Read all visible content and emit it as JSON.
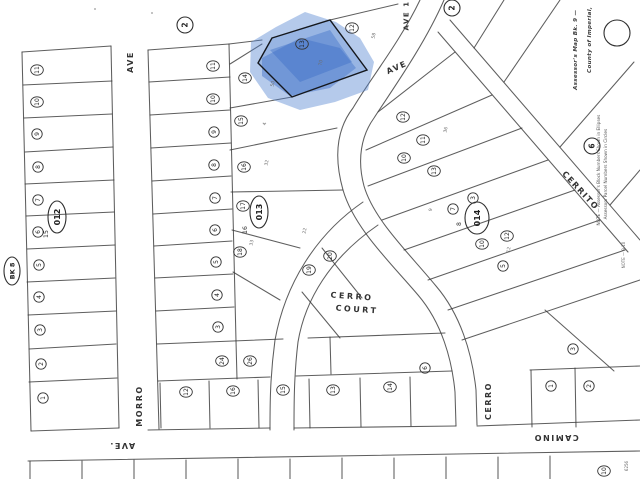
{
  "map": {
    "background": "#ffffff",
    "line_color": "#3a3a3a",
    "highlight": {
      "fill": "#4f81d0",
      "streak_fill": "#2f62c0",
      "wash_opacity": 0.42,
      "streak_opacity": 0.4,
      "lot_fill_opacity": 0.28,
      "wash": [
        [
          251,
          42
        ],
        [
          276,
          27
        ],
        [
          305,
          12
        ],
        [
          336,
          22
        ],
        [
          360,
          38
        ],
        [
          374,
          62
        ],
        [
          368,
          90
        ],
        [
          335,
          102
        ],
        [
          300,
          110
        ],
        [
          268,
          98
        ],
        [
          250,
          72
        ]
      ],
      "streaks": [
        [
          [
            262,
            58
          ],
          [
            300,
            38
          ],
          [
            340,
            48
          ],
          [
            356,
            68
          ],
          [
            330,
            88
          ],
          [
            290,
            96
          ],
          [
            262,
            76
          ]
        ],
        [
          [
            270,
            50
          ],
          [
            330,
            30
          ],
          [
            352,
            62
          ],
          [
            300,
            82
          ]
        ]
      ],
      "lot": [
        [
          272,
          38
        ],
        [
          330,
          20
        ],
        [
          367,
          70
        ],
        [
          292,
          97
        ],
        [
          258,
          63
        ]
      ]
    },
    "streets": {
      "ave_west": "AVE",
      "morro": "MORRO",
      "ave_south": "AVE.",
      "camino": "CAMINO",
      "cerro_court_1": "CERRO",
      "cerro_court_2": "COURT",
      "cerro": "CERRO",
      "cerrito": "CERRITO",
      "ave_diag": "AVE",
      "ave_one": "AVE 1"
    },
    "margin": {
      "line1": "Assessor's Map Bk. 9 —",
      "line2": "County of Imperial,",
      "note1": "NOTE — Assessor's Block Numbers Shown in Ellipses",
      "note2": "Assessors Parcel Numbers Shown in Circles",
      "side_note": "NOTE — 9-10",
      "corner_num": "6256"
    },
    "blocks": [
      {
        "label": "BK 8",
        "x": 12,
        "y": 271,
        "rx": 8,
        "ry": 14,
        "font": 6.5,
        "companion": "",
        "cx": 0,
        "cy": 0
      },
      {
        "label": "012",
        "x": 57,
        "y": 217,
        "rx": 9,
        "ry": 16,
        "font": 8,
        "companion": "15",
        "cx": 48,
        "cy": 234
      },
      {
        "label": "013",
        "x": 259,
        "y": 212,
        "rx": 9,
        "ry": 16,
        "font": 8,
        "companion": "16",
        "cx": 247,
        "cy": 230
      },
      {
        "label": "014",
        "x": 477,
        "y": 218,
        "rx": 12,
        "ry": 16,
        "font": 8,
        "companion": "8",
        "cx": 461,
        "cy": 224
      }
    ],
    "ref_circles": [
      {
        "label": "2",
        "x": 185,
        "y": 25,
        "r": 8
      },
      {
        "label": "2",
        "x": 452,
        "y": 8,
        "r": 8
      },
      {
        "label": "6",
        "x": 592,
        "y": 146,
        "r": 8
      },
      {
        "label": "",
        "x": 617,
        "y": 33,
        "r": 13
      }
    ],
    "parcels": [
      {
        "n": "11",
        "x": 37,
        "y": 70
      },
      {
        "n": "10",
        "x": 37,
        "y": 102
      },
      {
        "n": "9",
        "x": 37,
        "y": 134
      },
      {
        "n": "8",
        "x": 38,
        "y": 167
      },
      {
        "n": "7",
        "x": 38,
        "y": 200
      },
      {
        "n": "6",
        "x": 38,
        "y": 232
      },
      {
        "n": "5",
        "x": 39,
        "y": 265
      },
      {
        "n": "4",
        "x": 39,
        "y": 297
      },
      {
        "n": "3",
        "x": 40,
        "y": 330
      },
      {
        "n": "2",
        "x": 41,
        "y": 364
      },
      {
        "n": "1",
        "x": 43,
        "y": 398
      },
      {
        "n": "11",
        "x": 213,
        "y": 66
      },
      {
        "n": "10",
        "x": 213,
        "y": 99
      },
      {
        "n": "9",
        "x": 214,
        "y": 132
      },
      {
        "n": "8",
        "x": 214,
        "y": 165
      },
      {
        "n": "7",
        "x": 215,
        "y": 198
      },
      {
        "n": "6",
        "x": 215,
        "y": 230
      },
      {
        "n": "5",
        "x": 216,
        "y": 262
      },
      {
        "n": "4",
        "x": 217,
        "y": 295
      },
      {
        "n": "3",
        "x": 218,
        "y": 327
      },
      {
        "n": "14",
        "x": 245,
        "y": 78
      },
      {
        "n": "15",
        "x": 241,
        "y": 121
      },
      {
        "n": "16",
        "x": 244,
        "y": 167
      },
      {
        "n": "17",
        "x": 243,
        "y": 206
      },
      {
        "n": "18",
        "x": 240,
        "y": 252
      },
      {
        "n": "19",
        "x": 309,
        "y": 270
      },
      {
        "n": "20",
        "x": 330,
        "y": 256
      },
      {
        "n": "13",
        "x": 302,
        "y": 44
      },
      {
        "n": "12",
        "x": 352,
        "y": 28
      },
      {
        "n": "12",
        "x": 403,
        "y": 117
      },
      {
        "n": "11",
        "x": 423,
        "y": 140
      },
      {
        "n": "10",
        "x": 404,
        "y": 158
      },
      {
        "n": "13",
        "x": 434,
        "y": 171
      },
      {
        "n": "3",
        "x": 473,
        "y": 198
      },
      {
        "n": "7",
        "x": 453,
        "y": 209
      },
      {
        "n": "12",
        "x": 507,
        "y": 236
      },
      {
        "n": "10",
        "x": 482,
        "y": 244
      },
      {
        "n": "5",
        "x": 503,
        "y": 266
      },
      {
        "n": "24",
        "x": 222,
        "y": 361
      },
      {
        "n": "26",
        "x": 250,
        "y": 361
      },
      {
        "n": "12",
        "x": 186,
        "y": 392
      },
      {
        "n": "16",
        "x": 233,
        "y": 391
      },
      {
        "n": "15",
        "x": 283,
        "y": 390
      },
      {
        "n": "13",
        "x": 333,
        "y": 390
      },
      {
        "n": "14",
        "x": 390,
        "y": 387
      },
      {
        "n": "6",
        "x": 425,
        "y": 368
      },
      {
        "n": "3",
        "x": 573,
        "y": 349
      },
      {
        "n": "1",
        "x": 551,
        "y": 386
      },
      {
        "n": "2",
        "x": 589,
        "y": 386
      },
      {
        "n": "10",
        "x": 604,
        "y": 471
      }
    ],
    "dims": [
      {
        "t": "50",
        "x": 274,
        "y": 84
      },
      {
        "t": "70",
        "x": 322,
        "y": 63
      },
      {
        "t": "4",
        "x": 266,
        "y": 124
      },
      {
        "t": "32",
        "x": 268,
        "y": 163
      },
      {
        "t": "33",
        "x": 253,
        "y": 243
      },
      {
        "t": "22",
        "x": 306,
        "y": 231
      },
      {
        "t": "58",
        "x": 375,
        "y": 36
      },
      {
        "t": "36",
        "x": 447,
        "y": 130
      },
      {
        "t": "9",
        "x": 432,
        "y": 210
      },
      {
        "t": "12",
        "x": 510,
        "y": 250
      }
    ]
  }
}
